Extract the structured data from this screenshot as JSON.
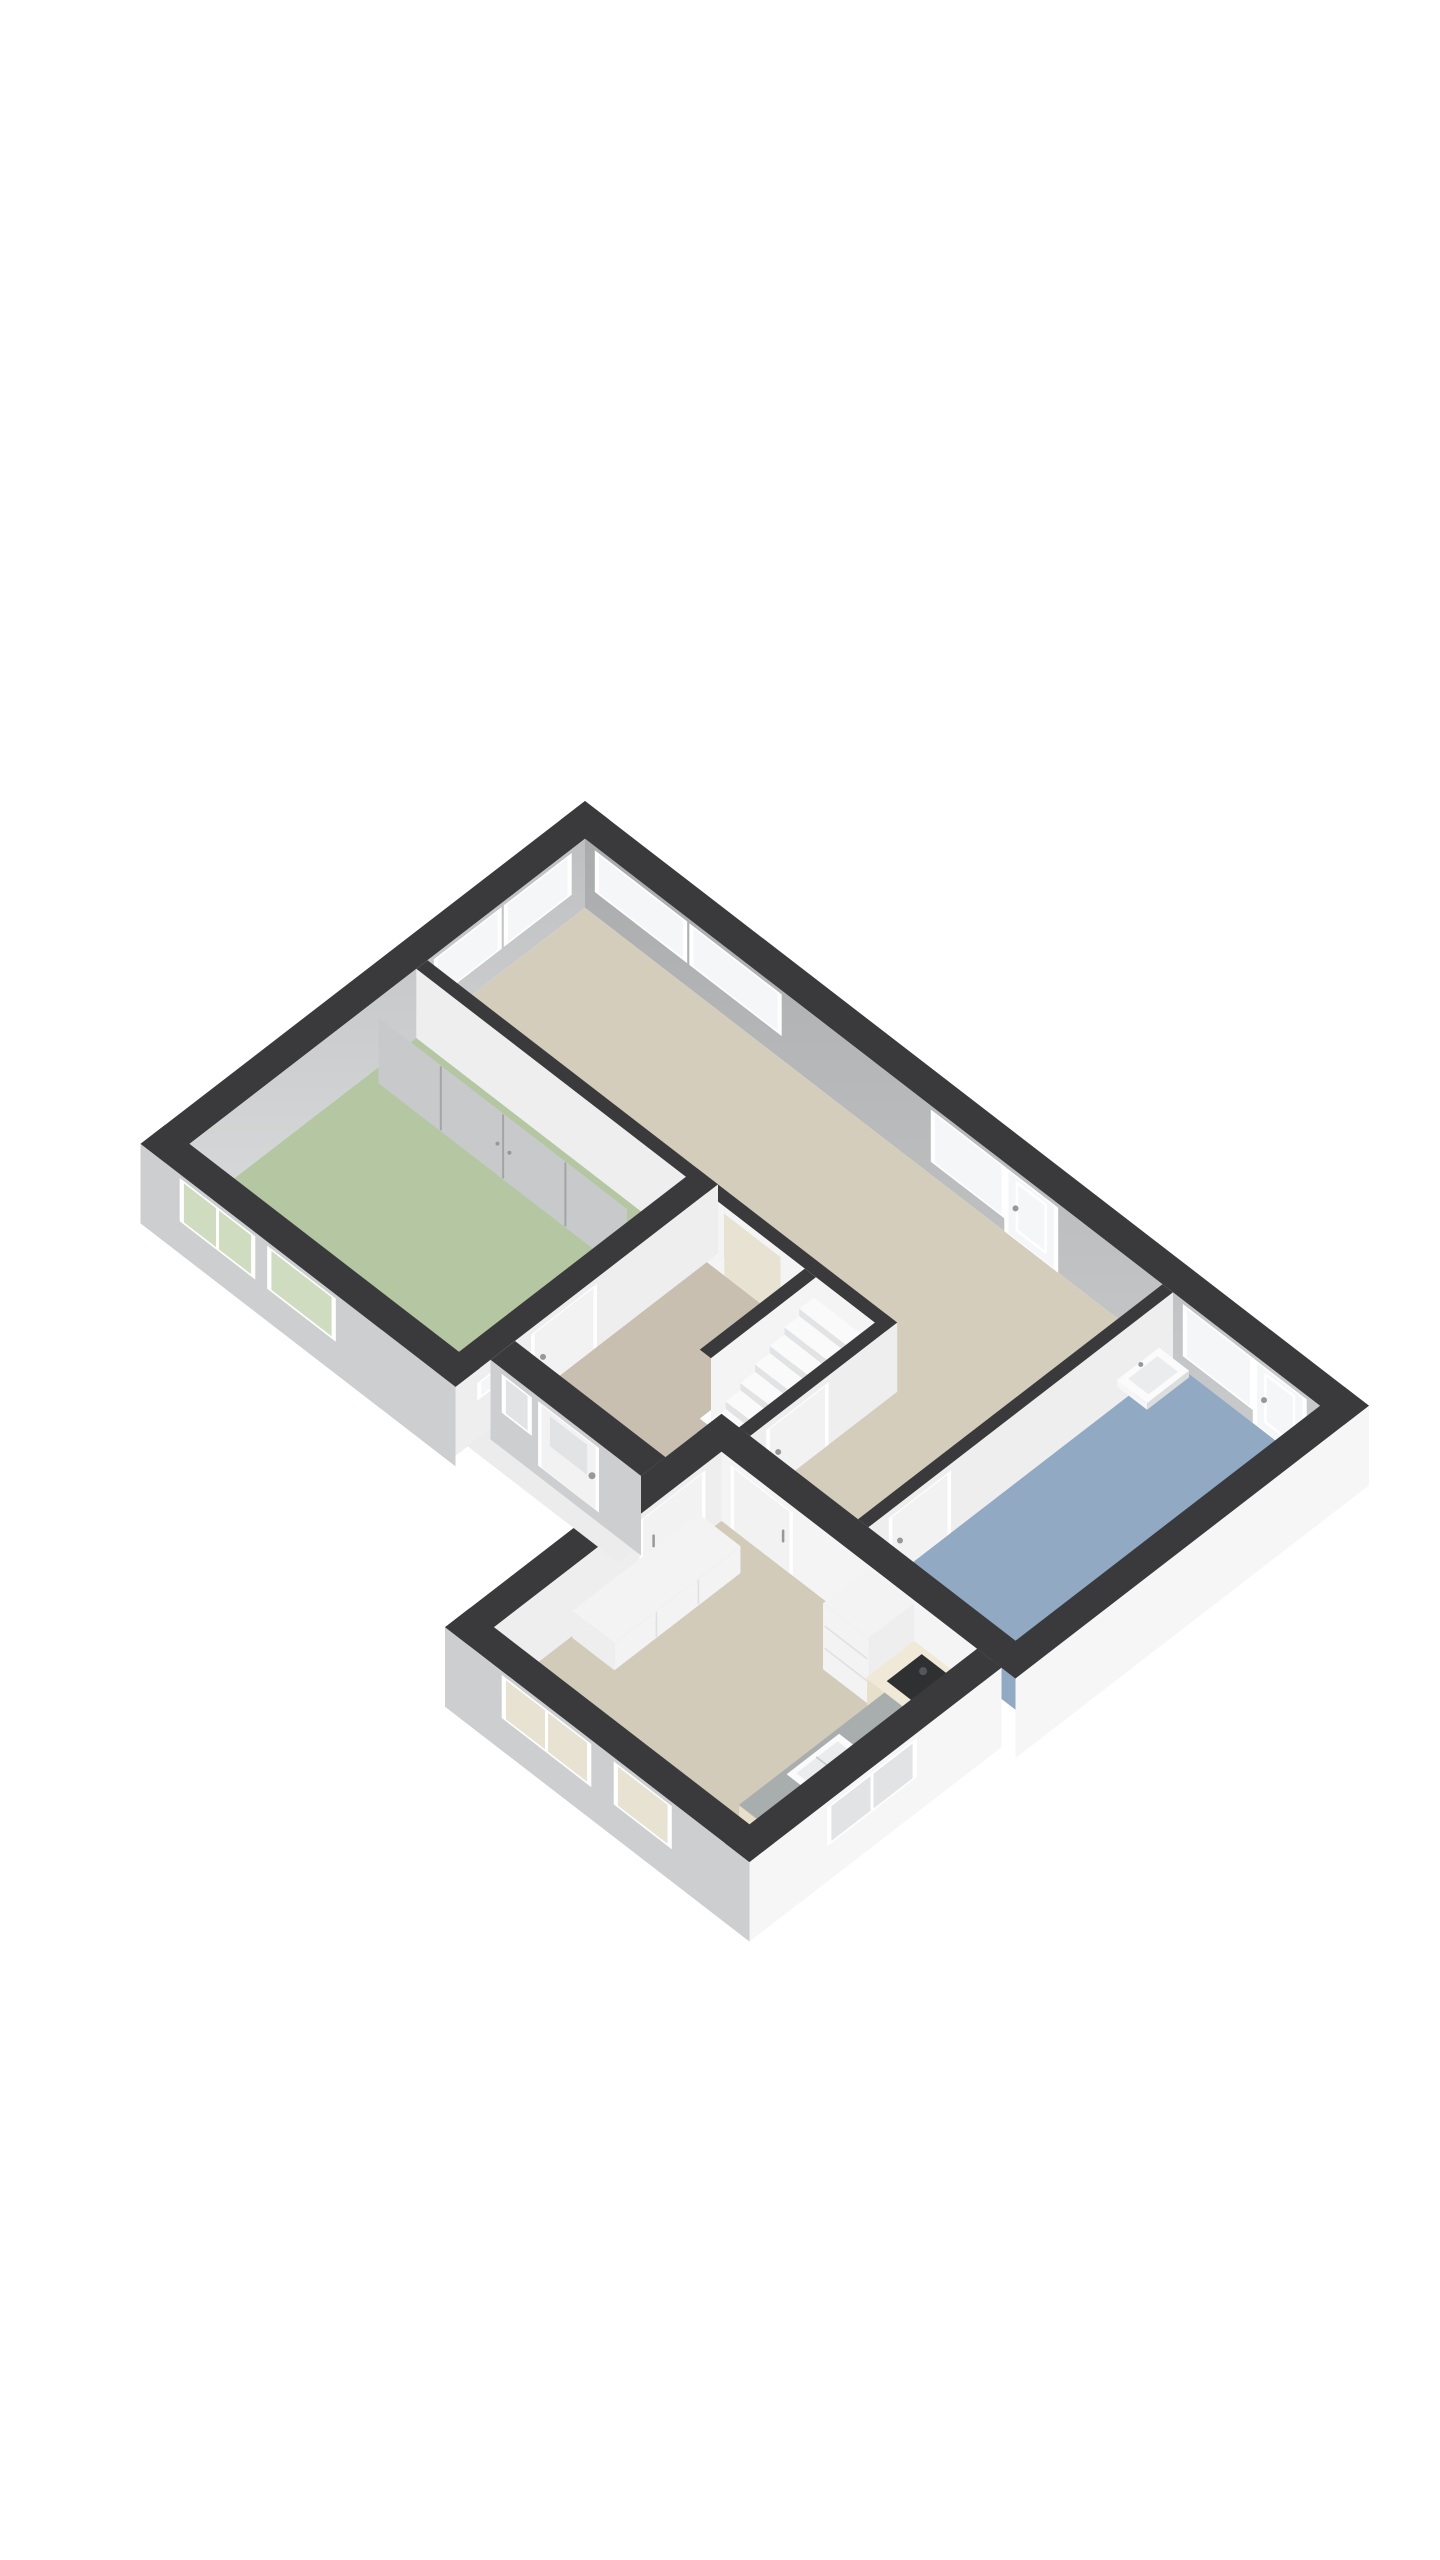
{
  "page": {
    "background": "#ffffff"
  },
  "scene": {
    "type": "isometric-3d-floorplan",
    "projection": "isometric",
    "storey": "single-floor"
  },
  "colors": {
    "background": "#ffffff",
    "wall_top_dark": "#3a3a3c",
    "wall_far_gray": "#a9abac",
    "wall_far_gray_light": "#cbcccd",
    "wall_far_gray2": "#bfc0c1",
    "wall_far_gray2_light": "#d8d9da",
    "wall_near_white": "#f6f6f7",
    "wall_near_shade": "#eeeeef",
    "wall_near_sw": "#cdcecf",
    "wall_int_white": "#f4f4f5",
    "slab": "#ececed",
    "slab_shade": "#dcdddd",
    "floor_living": "#d5cdbc",
    "floor_hall": "#c9bfb1",
    "floor_bedroom": "#b4c7a2",
    "floor_bathroom": "#92a9c4",
    "floor_kitchen": "#d3cbba",
    "window_frame": "#ffffff",
    "window_glass": "#f4f6f7",
    "glass_tint_green": "#cfdcbf",
    "glass_tint_beige": "#e7e2d2",
    "glass_tint_gray": "#e1e3e4",
    "closet_door": "#c8c9cb",
    "closet_seam": "#a3a4a6",
    "stairs": "#fafafb",
    "stairs_shade": "#e2e3e4",
    "cabinet_white": "#f3f3f4",
    "counter_cream": "#e7dfca",
    "counter_cream_top": "#f0e9d8",
    "counter_gray": "#a8adad",
    "cooktop_dark": "#2f3032",
    "cooktop_burner": "#55565a",
    "sink_white": "#fbfbfc",
    "sink_basin": "#eaeced",
    "sink_line": "#c6c9c9",
    "door_white": "#f2f2f3",
    "door_frame": "#ffffff",
    "handle_gray": "#97989a",
    "seam_light": "#dfe0e1"
  },
  "rooms": [
    {
      "id": "living-room",
      "floor": "floor_living",
      "shape": "L-shaped",
      "features": [
        "two windows north-west wall",
        "two windows north-east wall",
        "window with glass door north-east wall"
      ]
    },
    {
      "id": "bedroom",
      "floor": "floor_bedroom",
      "features": [
        "built-in wardrobe with sliding doors",
        "two windows south-west wall",
        "door to hallway"
      ]
    },
    {
      "id": "hallway",
      "floor": "floor_hall",
      "features": [
        "front door with glass panel",
        "sidelight window",
        "small porch window",
        "doorway to living room"
      ]
    },
    {
      "id": "staircase-nook",
      "floor": "floor_hall",
      "features": [
        "winder staircase",
        "under-stairs door"
      ]
    },
    {
      "id": "bathroom",
      "floor": "floor_bathroom",
      "features": [
        "wall-hung sink",
        "window with glass door north-east wall",
        "door from living area"
      ]
    },
    {
      "id": "kitchen",
      "floor": "floor_kitchen",
      "features": [
        "tall cabinet",
        "cream counter with dark cooktop",
        "gray counter with sink",
        "white sideboard",
        "two windows south-west wall",
        "window south-east wall",
        "sliding door to hallway",
        "door to living area"
      ]
    }
  ],
  "openings": {
    "window_count": 13,
    "door_count": 8,
    "windows": [
      "living-window-1",
      "living-window-2",
      "living-window-3",
      "living-window-4",
      "living-window-5",
      "bathroom-window",
      "bedroom-window-1",
      "bedroom-window-2",
      "kitchen-window-1",
      "kitchen-window-2",
      "kitchen-window-3",
      "porch-window",
      "front-sidelight"
    ],
    "doors": [
      "front-door",
      "living-glass-door",
      "bathroom-glass-door",
      "bedroom-door",
      "bathroom-door",
      "kitchen-door",
      "kitchen-sliding-door",
      "understairs-door"
    ]
  }
}
